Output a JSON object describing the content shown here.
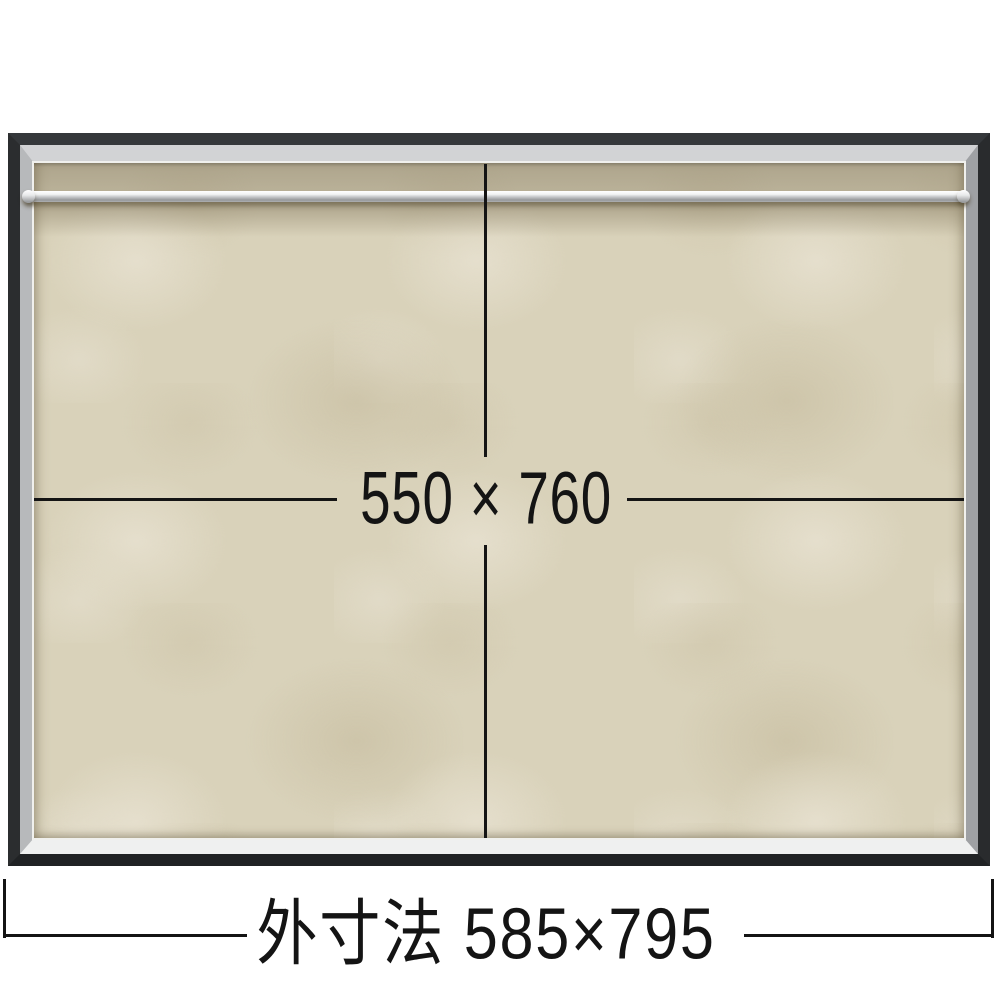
{
  "diagram": {
    "inner_size_label": "550 × 760",
    "outer_size_label": "外寸法 585×795"
  },
  "colors": {
    "page_background": "#ffffff",
    "outer_frame_dark": "#2c2f31",
    "inner_frame_silver": "#c6c8ca",
    "board_beige": "#d9d2ba",
    "rail_silver": "#dfe1e2",
    "dimension_line": "#141414",
    "label_text": "#141414"
  }
}
